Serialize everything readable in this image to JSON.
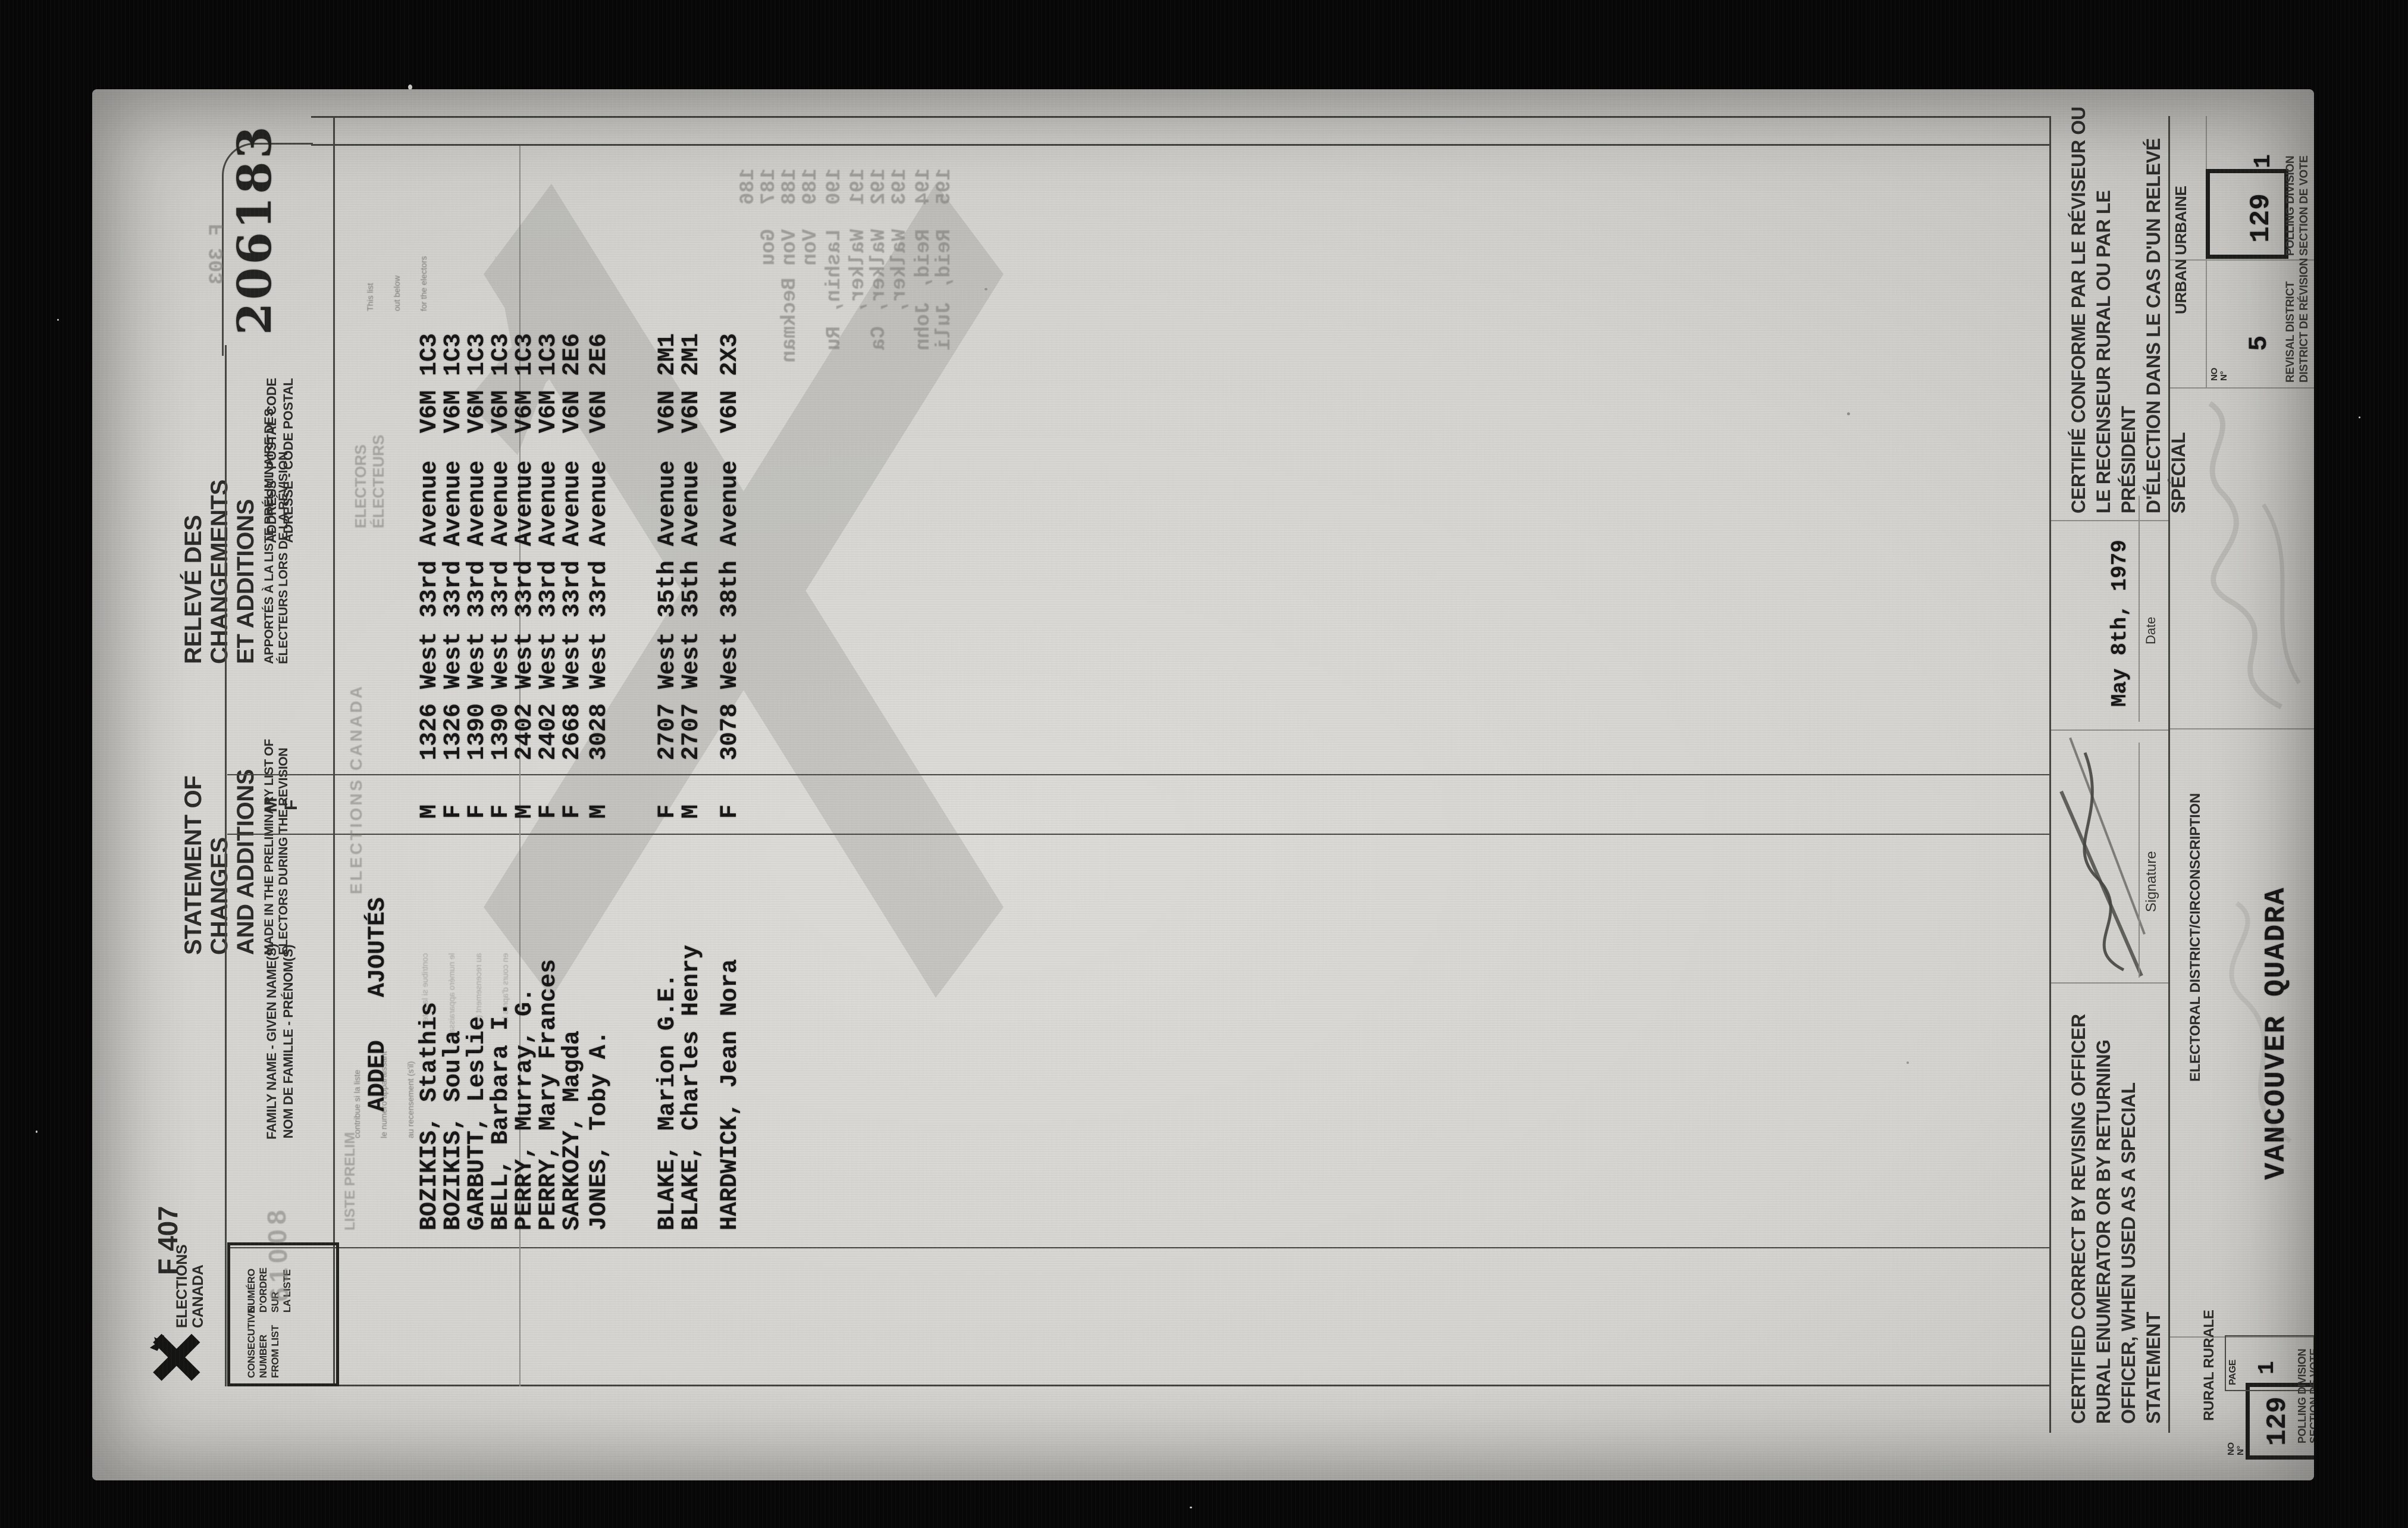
{
  "serial": "206183",
  "form_no": "F 407",
  "logo": {
    "line1": "ELECTIONS",
    "line2": "CANADA"
  },
  "title": {
    "en_main1": "STATEMENT OF CHANGES",
    "en_main2": "AND ADDITIONS",
    "en_sub1": "MADE IN THE PRELIMINARY LIST OF",
    "en_sub2": "ELECTORS DURING THE REVISION",
    "fr_main1": "RELEVÉ DES CHANGEMENTS",
    "fr_main2": "ET ADDITIONS",
    "fr_sub1": "APPORTÉS À LA LISTE PRÉLIMINAIRE DES",
    "fr_sub2": "ÉLECTEURS LORS DE LA RÉVISION"
  },
  "col1": {
    "en": [
      "CONSECUTIVE",
      "NUMBER",
      "FROM LIST"
    ],
    "fr": [
      "NUMÉRO",
      "D'ORDRE SUR",
      "LA LISTE"
    ]
  },
  "headers": {
    "name1": "FAMILY NAME - GIVEN NAME(S)",
    "name2": "NOM DE FAMILLE - PRÉNOM(S)",
    "sex1": "M",
    "sex2": "F",
    "addr1": "ADDRESS - POSTAL CODE",
    "addr2": "ADRESSE - CODE POSTAL"
  },
  "stamps": {
    "number": "61008",
    "liste": "LISTE PRELIM",
    "electors1": "ELECTORS",
    "electors2": "ÉLECTEURS",
    "watermark": "ELECTIONS CANADA"
  },
  "section_added": "ADDED   AJOUTÉS",
  "rows": [
    {
      "name": "BOZIKIS, Stathis",
      "sex": "M",
      "address": "1326 West 33rd Avenue",
      "postal": "V6M 1C3"
    },
    {
      "name": "BOZIKIS, Soula",
      "sex": "F",
      "address": "1326 West 33rd Avenue",
      "postal": "V6M 1C3"
    },
    {
      "name": "GARBUTT, Leslie",
      "sex": "F",
      "address": "1390 West 33rd Avenue",
      "postal": "V6M 1C3"
    },
    {
      "name": "BELL, Barbara I.",
      "sex": "F",
      "address": "1390 West 33rd Avenue",
      "postal": "V6M 1C3"
    },
    {
      "name": "PERRY, Murray, G.",
      "sex": "M",
      "address": "2402 West 33rd Avenue",
      "postal": "V6M 1C3"
    },
    {
      "name": "PERRY, Mary Frances",
      "sex": "F",
      "address": "2402 West 33rd Avenue",
      "postal": "V6M 1C3"
    },
    {
      "name": "SARKOZY, Magda",
      "sex": "F",
      "address": "2668 West 33rd Avenue",
      "postal": "V6N 2E6"
    },
    {
      "name": "JONES, Toby A.",
      "sex": "M",
      "address": "3028 West 33rd Avenue",
      "postal": "V6N 2E6"
    },
    {
      "name": "BLAKE, Marion G.E.",
      "sex": "F",
      "address": "2707 West 35th Avenue",
      "postal": "V6N 2M1"
    },
    {
      "name": "BLAKE, Charles Henry",
      "sex": "M",
      "address": "2707 West 35th Avenue",
      "postal": "V6N 2M1"
    },
    {
      "name": "HARDWICK, Jean Nora",
      "sex": "F",
      "address": "3078 West 38th Avenue",
      "postal": "V6N 2X3"
    }
  ],
  "fine_print": {
    "fr": [
      "contribue si la liste",
      "le numéro apparaissant",
      "au recensement (s'il)",
      "en cours d'après le"
    ],
    "en": [
      "This list",
      "out below",
      "for the electors"
    ]
  },
  "bleed": {
    "form_no": "F 303",
    "lines": [
      "186",
      "187  Gou",
      "188  Von Beckman",
      "189  Von",
      "190  Lashin, Ru",
      "191  Walker,",
      "192  Walker, Ca",
      "193  Walker,",
      "194  Reid, John",
      "195  Reid, Juli"
    ]
  },
  "cert": {
    "en": [
      "CERTIFIED CORRECT BY REVISING OFFICER",
      "RURAL ENUMERATOR OR BY RETURNING",
      "OFFICER, WHEN USED AS A SPECIAL",
      "STATEMENT"
    ],
    "fr": [
      "CERTIFIÉ CONFORME PAR LE RÉVISEUR OU",
      "LE RECENSEUR RURAL OU PAR LE PRÉSIDENT",
      "D'ÉLECTION DANS LE CAS D'UN RELEVÉ",
      "SPÉCIAL"
    ],
    "signature_label": "Signature",
    "date_label": "Date",
    "date_value": "May 8th, 1979"
  },
  "footer": {
    "district_label": "ELECTORAL DISTRICT/CIRCONSCRIPTION",
    "district_value": "VANCOUVER QUADRA",
    "urban": "URBAN   URBAINE",
    "rural": "RURAL   RURALE",
    "no_label": "NO",
    "no_label_fr": "N°",
    "page_label": "PAGE",
    "page_value": "1",
    "list_no": "129",
    "polling1": "POLLING DIVISION",
    "polling2": "SECTION DE VOTE",
    "revisal1": "REVISAL DISTRICT",
    "revisal2": "DISTRICT DE RÉVISION",
    "revisal_no": "5",
    "polling_no": "129",
    "polling_page": "1"
  }
}
